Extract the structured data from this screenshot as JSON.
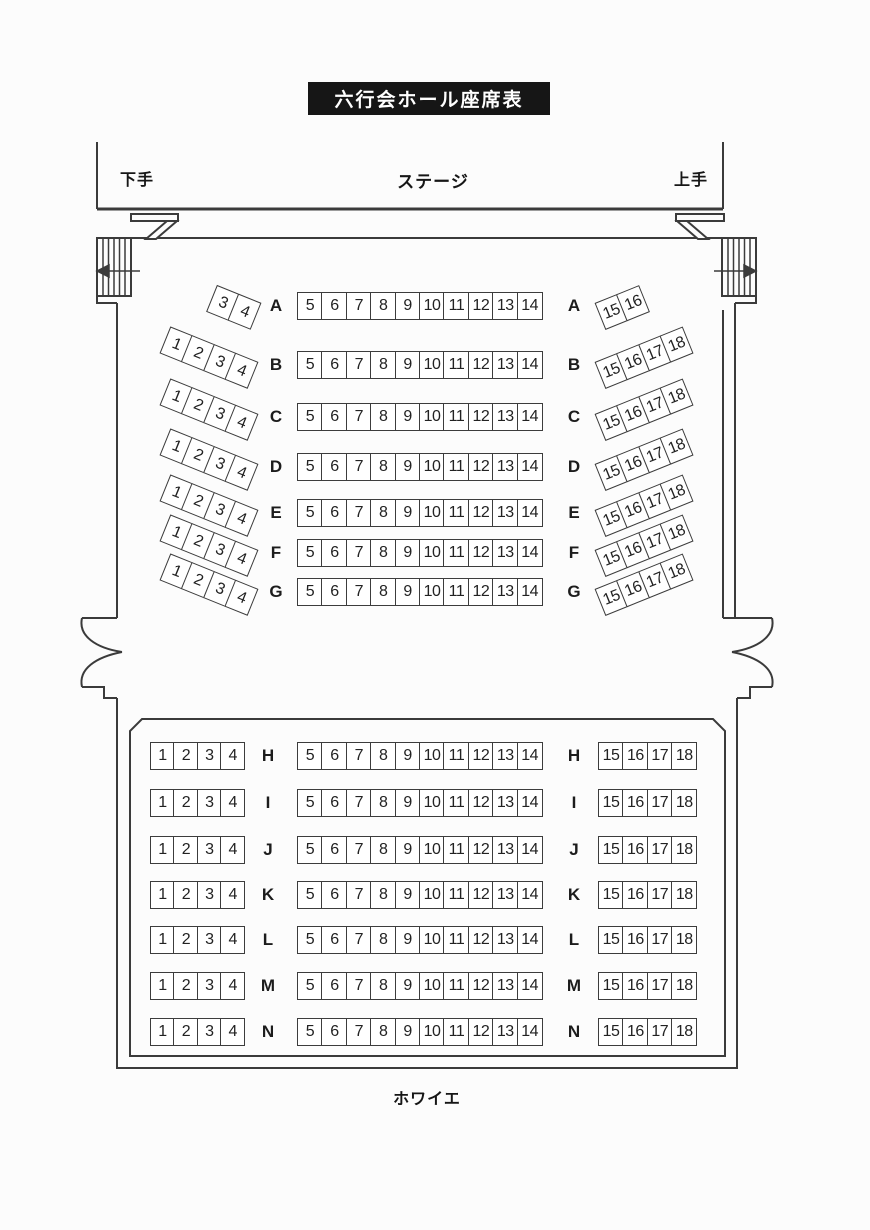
{
  "title": "六行会ホール座席表",
  "stage": {
    "label": "ステージ",
    "stage_left_label": "下手",
    "stage_right_label": "上手"
  },
  "foyer": {
    "label": "ホワイエ"
  },
  "upper_rows": [
    {
      "letter": "A",
      "left": [
        "3",
        "4"
      ],
      "center": [
        "5",
        "6",
        "7",
        "8",
        "9",
        "10",
        "11",
        "12",
        "13",
        "14"
      ],
      "right": [
        "15",
        "16"
      ]
    },
    {
      "letter": "B",
      "left": [
        "1",
        "2",
        "3",
        "4"
      ],
      "center": [
        "5",
        "6",
        "7",
        "8",
        "9",
        "10",
        "11",
        "12",
        "13",
        "14"
      ],
      "right": [
        "15",
        "16",
        "17",
        "18"
      ]
    },
    {
      "letter": "C",
      "left": [
        "1",
        "2",
        "3",
        "4"
      ],
      "center": [
        "5",
        "6",
        "7",
        "8",
        "9",
        "10",
        "11",
        "12",
        "13",
        "14"
      ],
      "right": [
        "15",
        "16",
        "17",
        "18"
      ]
    },
    {
      "letter": "D",
      "left": [
        "1",
        "2",
        "3",
        "4"
      ],
      "center": [
        "5",
        "6",
        "7",
        "8",
        "9",
        "10",
        "11",
        "12",
        "13",
        "14"
      ],
      "right": [
        "15",
        "16",
        "17",
        "18"
      ]
    },
    {
      "letter": "E",
      "left": [
        "1",
        "2",
        "3",
        "4"
      ],
      "center": [
        "5",
        "6",
        "7",
        "8",
        "9",
        "10",
        "11",
        "12",
        "13",
        "14"
      ],
      "right": [
        "15",
        "16",
        "17",
        "18"
      ]
    },
    {
      "letter": "F",
      "left": [
        "1",
        "2",
        "3",
        "4"
      ],
      "center": [
        "5",
        "6",
        "7",
        "8",
        "9",
        "10",
        "11",
        "12",
        "13",
        "14"
      ],
      "right": [
        "15",
        "16",
        "17",
        "18"
      ]
    },
    {
      "letter": "G",
      "left": [
        "1",
        "2",
        "3",
        "4"
      ],
      "center": [
        "5",
        "6",
        "7",
        "8",
        "9",
        "10",
        "11",
        "12",
        "13",
        "14"
      ],
      "right": [
        "15",
        "16",
        "17",
        "18"
      ]
    }
  ],
  "lower_rows": [
    {
      "letter": "H",
      "left": [
        "1",
        "2",
        "3",
        "4"
      ],
      "center": [
        "5",
        "6",
        "7",
        "8",
        "9",
        "10",
        "11",
        "12",
        "13",
        "14"
      ],
      "right": [
        "15",
        "16",
        "17",
        "18"
      ]
    },
    {
      "letter": "I",
      "left": [
        "1",
        "2",
        "3",
        "4"
      ],
      "center": [
        "5",
        "6",
        "7",
        "8",
        "9",
        "10",
        "11",
        "12",
        "13",
        "14"
      ],
      "right": [
        "15",
        "16",
        "17",
        "18"
      ]
    },
    {
      "letter": "J",
      "left": [
        "1",
        "2",
        "3",
        "4"
      ],
      "center": [
        "5",
        "6",
        "7",
        "8",
        "9",
        "10",
        "11",
        "12",
        "13",
        "14"
      ],
      "right": [
        "15",
        "16",
        "17",
        "18"
      ]
    },
    {
      "letter": "K",
      "left": [
        "1",
        "2",
        "3",
        "4"
      ],
      "center": [
        "5",
        "6",
        "7",
        "8",
        "9",
        "10",
        "11",
        "12",
        "13",
        "14"
      ],
      "right": [
        "15",
        "16",
        "17",
        "18"
      ]
    },
    {
      "letter": "L",
      "left": [
        "1",
        "2",
        "3",
        "4"
      ],
      "center": [
        "5",
        "6",
        "7",
        "8",
        "9",
        "10",
        "11",
        "12",
        "13",
        "14"
      ],
      "right": [
        "15",
        "16",
        "17",
        "18"
      ]
    },
    {
      "letter": "M",
      "left": [
        "1",
        "2",
        "3",
        "4"
      ],
      "center": [
        "5",
        "6",
        "7",
        "8",
        "9",
        "10",
        "11",
        "12",
        "13",
        "14"
      ],
      "right": [
        "15",
        "16",
        "17",
        "18"
      ]
    },
    {
      "letter": "N",
      "left": [
        "1",
        "2",
        "3",
        "4"
      ],
      "center": [
        "5",
        "6",
        "7",
        "8",
        "9",
        "10",
        "11",
        "12",
        "13",
        "14"
      ],
      "right": [
        "15",
        "16",
        "17",
        "18"
      ]
    }
  ],
  "colors": {
    "line": "#3b3b3b",
    "title_bg": "#161616",
    "title_fg": "#ffffff",
    "paper": "#fcfcfc"
  }
}
